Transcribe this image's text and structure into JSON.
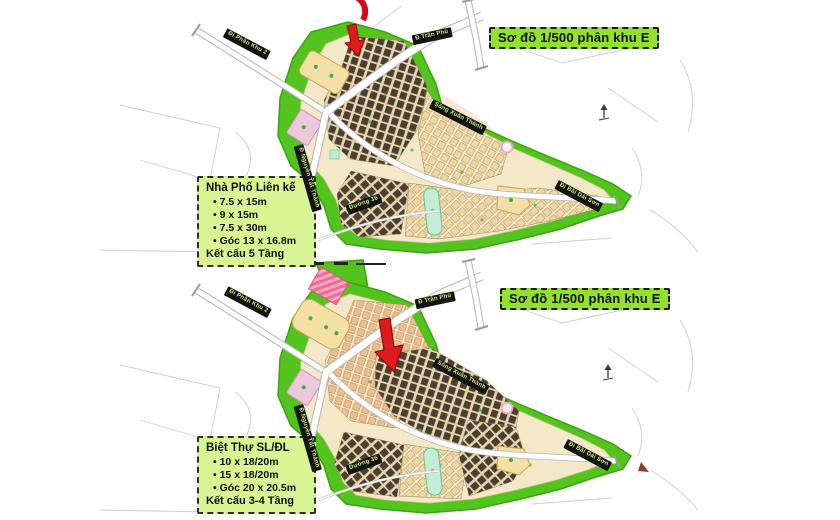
{
  "title_badge": "Sơ đồ 1/500 phân khu E",
  "maps": [
    {
      "name": "top-plan",
      "info_box": {
        "title": "Nhà Phố Liên kế",
        "items": [
          "7.5 x 15m",
          "9 x 15m",
          "7.5 x 30m",
          "Góc 13 x 16.8m"
        ],
        "footer": "Kết cấu 5 Tầng"
      }
    },
    {
      "name": "bottom-plan",
      "info_box": {
        "title": "Biệt Thự SL/ĐL",
        "items": [
          "10 x 18/20m",
          "15 x 18/20m",
          "Góc 20 x 20.5m"
        ],
        "footer": "Kết cấu 3-4 Tầng"
      }
    }
  ],
  "road_labels": {
    "phan_khu_2": "Đi Phân Khu 2",
    "tran_phu": "Đ Trần Phú",
    "nguyen_tat_thanh": "Đ Nguyễn Tất Thành",
    "song_xuan_thanh": "Sông Xuân Thành",
    "duong_36": "Đường 36",
    "bai_dai_son": "Đi Bãi Dài Sơn"
  },
  "colors": {
    "site_green": "#53c41d",
    "badge_green": "#94e02c",
    "box_green": "#d9f593",
    "cream": "#f3e8c8",
    "dark_block": "#4b3f31",
    "yellow_parcel": "#f4dfa4",
    "pink_parcel": "#edc7db",
    "teal_strip": "#c5ecd9",
    "arrow_red": "#de1b1b",
    "ribbon_bg": "#131313",
    "ribbon_text": "#c9e982"
  }
}
